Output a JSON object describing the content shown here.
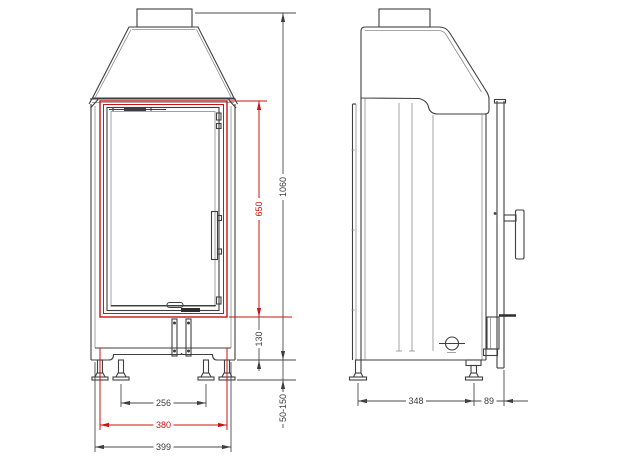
{
  "drawing": {
    "colors": {
      "accent_red": "#cc1212",
      "line_gray": "#3f3f3f",
      "background": "#ffffff"
    },
    "front_view": {
      "dims": {
        "door_height": "650",
        "total_height": "1060",
        "base_height": "130",
        "leg_height_range": "50-150",
        "inner_leg_spacing": "256",
        "frame_width": "380",
        "total_width": "399"
      }
    },
    "side_view": {
      "dims": {
        "depth": "348",
        "front_offset": "89"
      }
    }
  }
}
